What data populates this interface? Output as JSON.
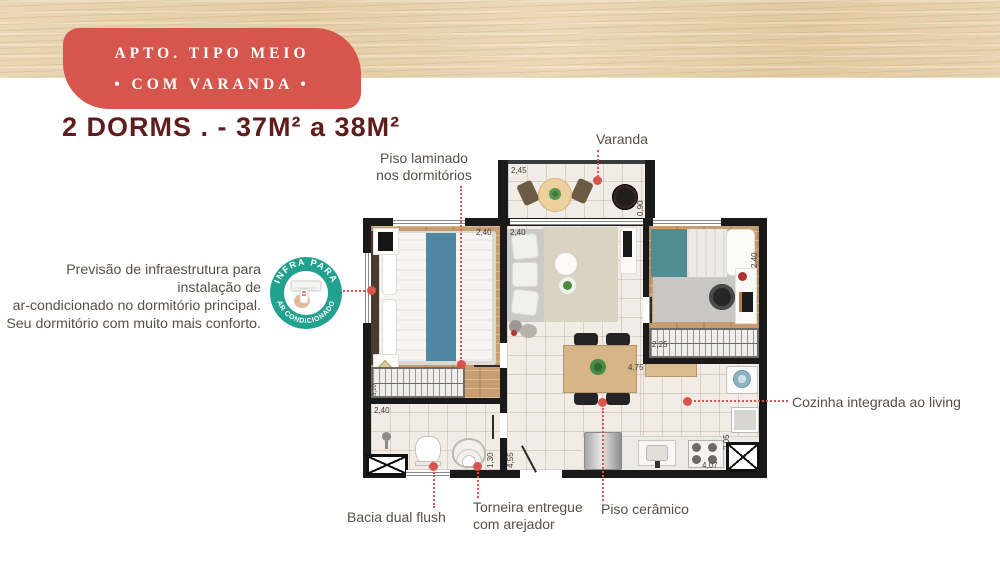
{
  "colors": {
    "accent_red": "#d9544d",
    "badge_bg": "#d6564e",
    "title_color": "#5e1d1d",
    "infra_teal": "#23a18f",
    "label_gray": "#55504a",
    "wall_black": "#1a1a1a",
    "wood_band": "#e9d3b0"
  },
  "header": {
    "badge_line1": "APTO. TIPO MEIO",
    "badge_line2": "• COM VARANDA •",
    "title": "2 DORMS . - 37M² a 38M²"
  },
  "infra_badge": {
    "arc_top": "INFRA PARA",
    "arc_bottom": "AR CONDICIONADO"
  },
  "notes": {
    "ac_line1": "Previsão de infraestrutura para instalação de",
    "ac_line2": "ar-condicionado no dormitório principal.",
    "ac_line3": "Seu dormitório com muito mais conforto."
  },
  "labels": {
    "piso_laminado_1": "Piso laminado",
    "piso_laminado_2": "nos dormitórios",
    "varanda": "Varanda",
    "cozinha": "Cozinha integrada ao living",
    "bacia": "Bacia dual flush",
    "torneira_1": "Torneira entregue",
    "torneira_2": "com arejador",
    "piso_ceramico": "Piso cerâmico"
  },
  "plan": {
    "dims": {
      "varanda_w": "2,45",
      "varanda_d": "0,90",
      "dorm1_w": "2,40",
      "living_w": "2,40",
      "dorm2_d": "2,40",
      "dorm2_closet": "2,25",
      "living_l": "4,75",
      "bath_w": "2,40",
      "bath_l": "1,30",
      "hall_l": "4,55",
      "kitchen_d": "2,05",
      "kitchen_l": "4,07",
      "dorm1_closet": "3,10"
    }
  }
}
